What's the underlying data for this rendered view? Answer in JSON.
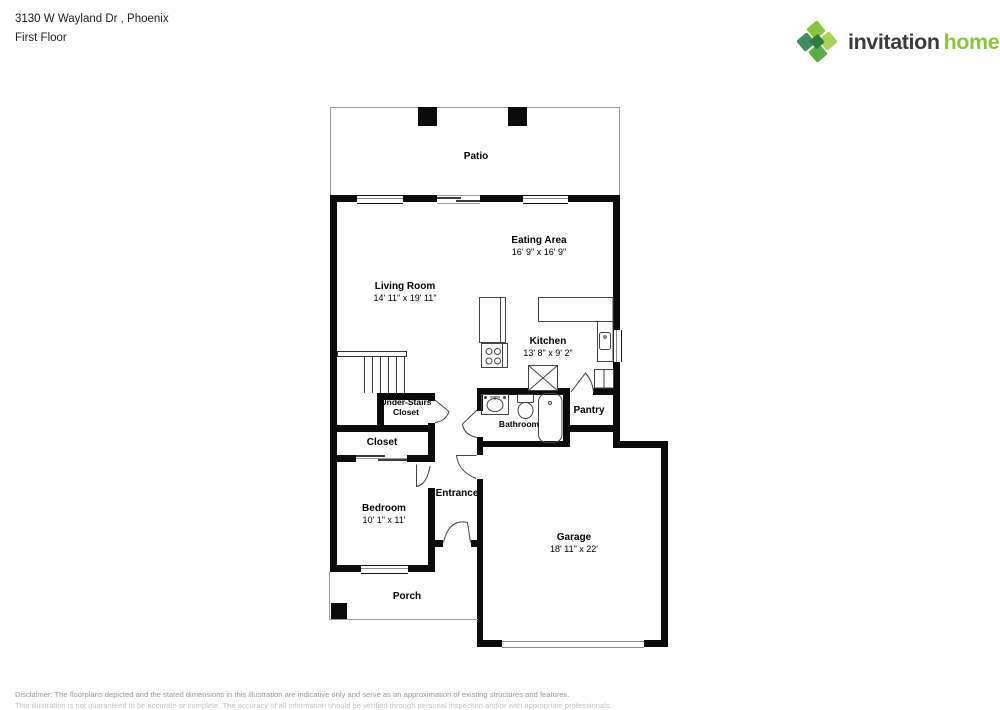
{
  "header": {
    "address": "3130 W Wayland Dr , Phoenix",
    "floor_label": "First Floor"
  },
  "logo": {
    "word1": "invitation",
    "word2": "homes",
    "trademark": "™",
    "colors": {
      "word1": "#3b3b3d",
      "word2": "#8cc63f",
      "mark_greens": [
        "#8ac541",
        "#aad159",
        "#3e8e5e",
        "#5cad47",
        "#2f7c3e"
      ]
    }
  },
  "plan": {
    "rooms": {
      "patio": {
        "name": "Patio",
        "dims": ""
      },
      "eating_area": {
        "name": "Eating Area",
        "dims": "16' 9\" x 16' 9\""
      },
      "living_room": {
        "name": "Living Room",
        "dims": "14' 11\" x 19' 11\""
      },
      "kitchen": {
        "name": "Kitchen",
        "dims": "13' 8\" x 9' 2\""
      },
      "under_stairs_closet": {
        "name": "Under-Stairs Closet",
        "dims": ""
      },
      "closet": {
        "name": "Closet",
        "dims": ""
      },
      "bathroom": {
        "name": "Bathroom",
        "dims": ""
      },
      "pantry": {
        "name": "Pantry",
        "dims": ""
      },
      "bedroom": {
        "name": "Bedroom",
        "dims": "10' 1\" x 11'"
      },
      "entrance": {
        "name": "Entrance",
        "dims": ""
      },
      "garage": {
        "name": "Garage",
        "dims": "18' 11\" x 22'"
      },
      "porch": {
        "name": "Porch",
        "dims": ""
      }
    },
    "fixtures": [
      "stairs",
      "refrigerator",
      "stove",
      "kitchen-island",
      "kitchen-sink",
      "bathroom-sink",
      "toilet",
      "bathtub"
    ]
  },
  "disclaimer": {
    "line1": "Disclaimer: The floorplans depicted and the stated dimensions in this illustration are indicative only and serve as an approximation of existing structures and features.",
    "line2": "This illustration is not guaranteed to be accurate or complete. The accuracy of all information should be verified through personal inspection and/or with appropriate professionals."
  }
}
